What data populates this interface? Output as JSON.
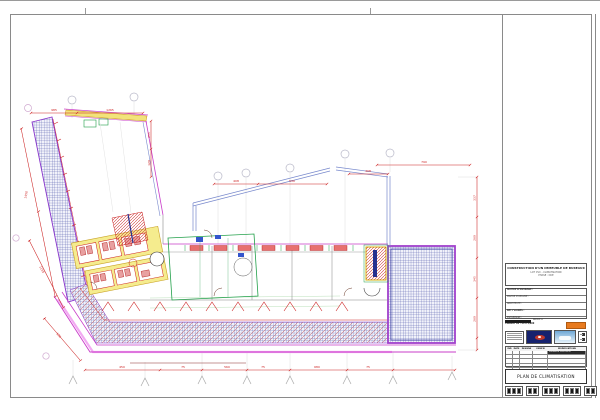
{
  "palette": {
    "magenta": "#c93ec9",
    "purple": "#8833cc",
    "pink": "#f2aaf2",
    "dim_red": "#cc2020",
    "green": "#22a04a",
    "yellow_wall": "#f5ec8e",
    "hatch_blue": "#4a52a8",
    "navy": "#24308f",
    "accent_orange": "#e87a1e"
  },
  "titleblock": {
    "project_lines": [
      "CONSTRUCTION D'UN IMMEUBLE DE BUREAUX",
      "LOT CVC - CLIMATISATION",
      "PHASE : DCE"
    ],
    "rows": [
      {
        "label": "MAITRE D'OUVRAGE :"
      },
      {
        "label": "MAITRE D'OEUVRE :"
      },
      {
        "label": "ARCHITECTE :"
      },
      {
        "label": "BET FLUIDES :"
      },
      {
        "label": "ENTREPRISE :"
      }
    ],
    "indice_label": "INDICE A",
    "format_label": "FORMAT A1 - ECH 1/100",
    "rev": {
      "headers": [
        "IND",
        "DATE",
        "DESSINE",
        "VERIFIE",
        "MODIFICATIONS"
      ],
      "note": "PREMIERE DIFFUSION"
    },
    "drawing_title": "PLAN DE CLIMATISATION"
  },
  "drawing": {
    "dims": {
      "a1": "985",
      "a2": "1265",
      "b1": "255",
      "b2": "120",
      "c1": "408",
      "c2": "530",
      "d1": "790",
      "e1": "408",
      "f1": "337",
      "f2": "260",
      "f3": "345",
      "f4": "260",
      "g1": "450",
      "g2": "75",
      "g3": "560",
      "g4": "75",
      "g5": "680",
      "g6": "75",
      "i1": "1165",
      "j1": "530",
      "k1": "1450"
    }
  }
}
